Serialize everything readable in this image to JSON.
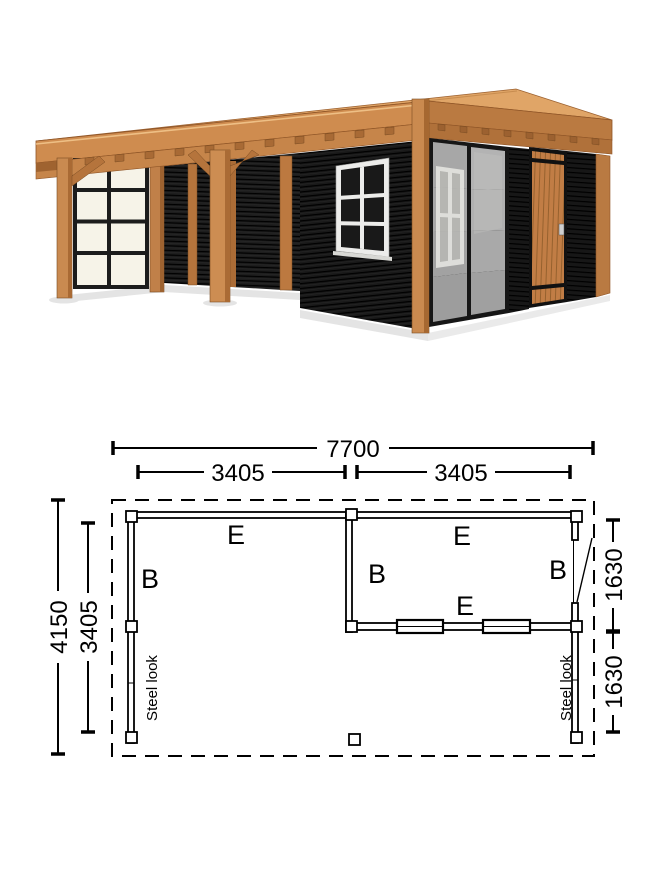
{
  "illustration": {
    "description": "3D render of timber flat-roof garden room with open veranda, black slatted walls, steel-look glazing and wooden door",
    "colors": {
      "wood_light": "#e0a567",
      "wood_mid": "#cd8c4f",
      "wood_dark": "#b5743c",
      "wood_shadow": "#a2halt",
      "wall_black": "#1b1b1b",
      "pane_cream": "#f6f3e8",
      "glass_gray": "#a7a7a7",
      "frame_black": "#1c1c1c",
      "plan_line": "#000000"
    }
  },
  "plan": {
    "dims": {
      "total_width": "7700",
      "left_bay": "3405",
      "right_bay": "3405",
      "total_depth": "4150",
      "inner_depth": "3405",
      "right_upper": "1630",
      "right_lower": "1630"
    },
    "labels": {
      "left_room_top": "E",
      "left_room_side": "B",
      "right_room_top": "E",
      "right_room_left": "B",
      "right_room_right": "B",
      "right_room_bottom": "E"
    },
    "panels": {
      "left": "Steel look",
      "right": "Steel look"
    }
  }
}
